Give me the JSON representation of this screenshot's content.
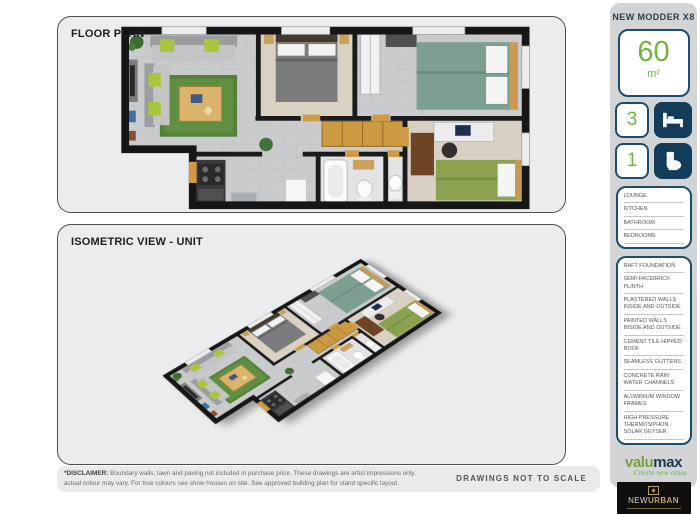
{
  "panels": {
    "floor_plan_title": "FLOOR PLAN",
    "isometric_title": "ISOMETRIC VIEW - UNIT"
  },
  "sidebar": {
    "title": "NEW MODDER X8",
    "area": {
      "value": "60",
      "unit": "m²"
    },
    "stats": [
      {
        "count": "3",
        "icon": "bed-icon"
      },
      {
        "count": "1",
        "icon": "toilet-icon"
      }
    ],
    "rooms": [
      "LOUNGE",
      "KITCHEN",
      "BATHROOM",
      "BEDROOMS"
    ],
    "specs": [
      "RAFT FOUNDATION",
      "SEMI-FACEBRICK PLINTH",
      "PLASTERED WALLS INSIDE AND OUTSIDE",
      "PAINTED WALLS INSIDE AND OUTSIDE",
      "CEMENT TILE HIPPED ROOF",
      "SEAMLESS GUTTERS",
      "CONCRETE RAIN WATER CHANNELS",
      "ALUMINIUM WINDOW FRAMES",
      "HIGH PRESSURE THERMOSIPHON SOLAR GEYSER"
    ],
    "logos": {
      "valumax": {
        "part1": "valu",
        "part2": "max",
        "tagline": "Create new cities"
      },
      "newurban": {
        "part1": "NEW",
        "part2": "URBAN"
      }
    }
  },
  "footer": {
    "disclaimer_label": "*DISCLAIMER:",
    "disclaimer_text": " Boundary walls, lawn and paving not included in purchase price. These drawings are artist impressions only, actual colour may vary. For true colours see show houses on site. See approved building plan for stand specific layout.",
    "scale_note": "DRAWINGS NOT TO SCALE"
  },
  "colors": {
    "accent_green": "#6fb53c",
    "navy": "#1c4d6e",
    "icon_box_navy": "#123c59",
    "panel_fill": "#ebeced",
    "sidebar_fill": "#d2d4d5",
    "gold": "#b79c62"
  }
}
